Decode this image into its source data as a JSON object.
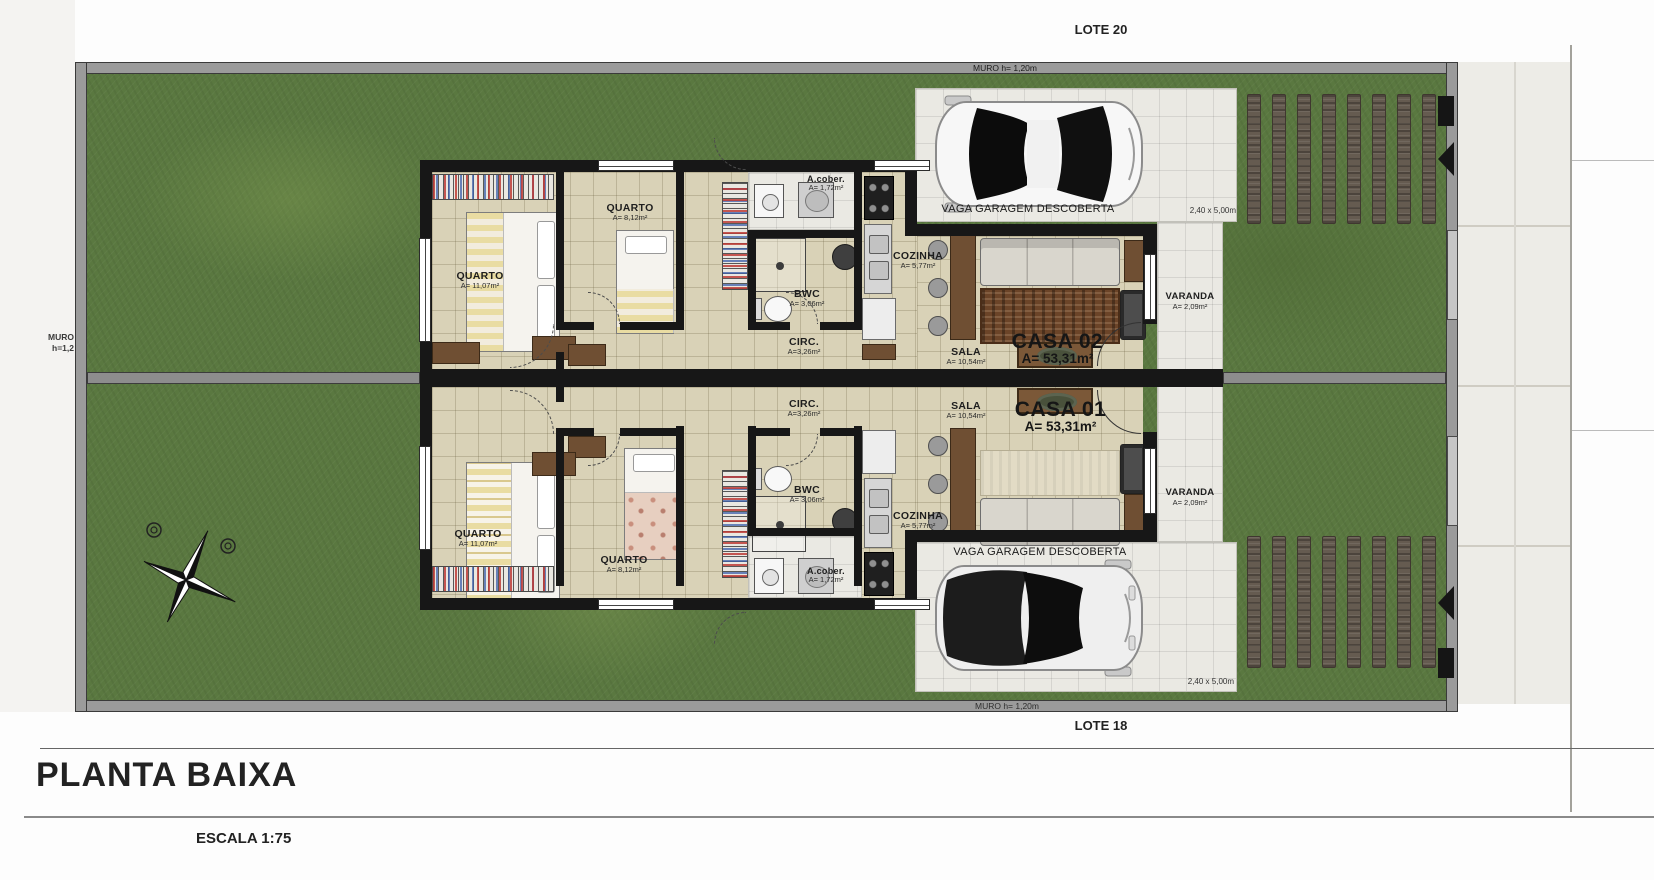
{
  "page": {
    "title": "PLANTA BAIXA",
    "scale": "ESCALA 1:75"
  },
  "site": {
    "lote_top": "LOTE 20",
    "lote_bottom": "LOTE 18",
    "muro_top": "MURO h= 1,20m",
    "muro_bottom": "MURO h= 1,20m",
    "muro_left_l1": "MURO",
    "muro_left_l2": "h=1,2"
  },
  "casa02": {
    "name": "CASA 02",
    "area": "A= 53,31m²",
    "quarto1": {
      "name": "QUARTO",
      "area": "A= 11,07m²"
    },
    "quarto2": {
      "name": "QUARTO",
      "area": "A= 8,12m²"
    },
    "bwc": {
      "name": "BWC",
      "area": "A= 3,06m²"
    },
    "acober": {
      "name": "A.cober.",
      "area": "A= 1,72m²"
    },
    "cozinha": {
      "name": "COZINHA",
      "area": "A= 5,77m²"
    },
    "circ": {
      "name": "CIRC.",
      "area": "A=3,26m²"
    },
    "sala": {
      "name": "SALA",
      "area": "A= 10,54m²"
    },
    "varanda": {
      "name": "VARANDA",
      "area": "A= 2,09m²"
    },
    "garage": {
      "label": "VAGA GARAGEM DESCOBERTA",
      "dims": "2,40 x 5,00m"
    }
  },
  "casa01": {
    "name": "CASA 01",
    "area": "A= 53,31m²",
    "quarto1": {
      "name": "QUARTO",
      "area": "A= 11,07m²"
    },
    "quarto2": {
      "name": "QUARTO",
      "area": "A= 8,12m²"
    },
    "bwc": {
      "name": "BWC",
      "area": "A= 3,06m²"
    },
    "acober": {
      "name": "A.cober.",
      "area": "A= 1,72m²"
    },
    "cozinha": {
      "name": "COZINHA",
      "area": "A= 5,77m²"
    },
    "circ": {
      "name": "CIRC.",
      "area": "A=3,26m²"
    },
    "sala": {
      "name": "SALA",
      "area": "A= 10,54m²"
    },
    "varanda": {
      "name": "VARANDA",
      "area": "A= 2,09m²"
    },
    "garage": {
      "label": "VAGA GARAGEM DESCOBERTA",
      "dims": "2,40 x 5,00m"
    }
  }
}
